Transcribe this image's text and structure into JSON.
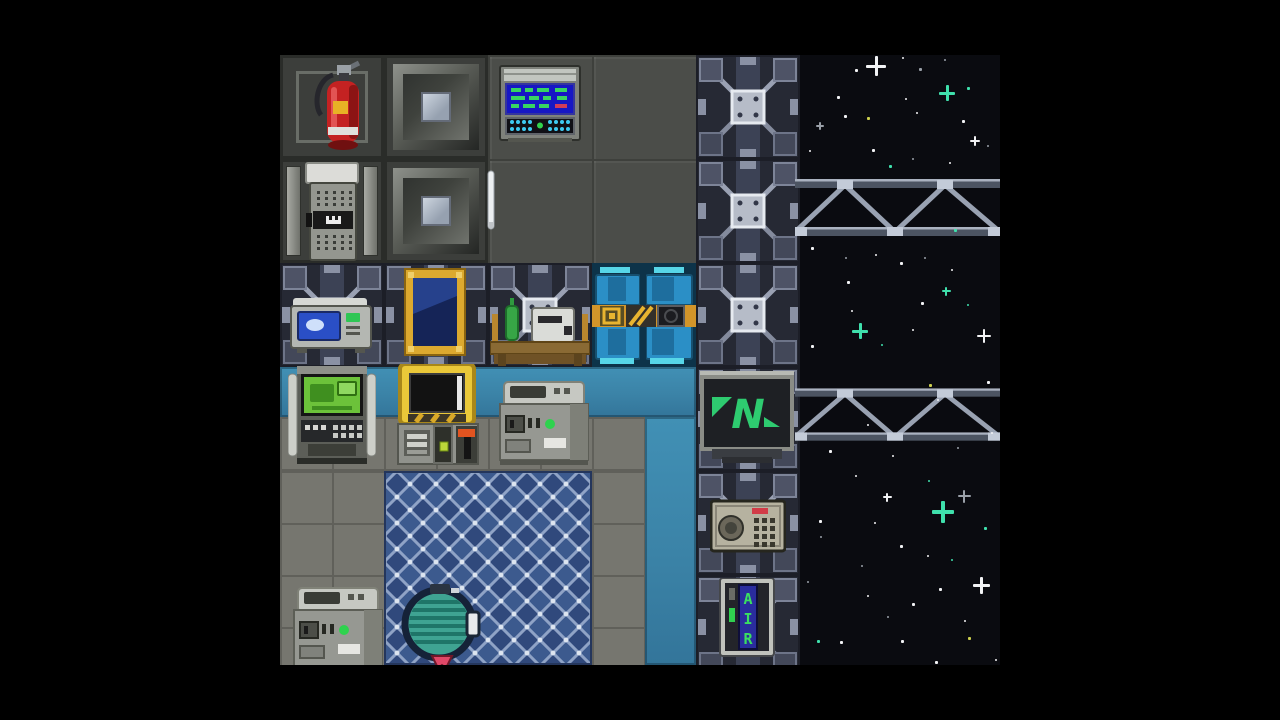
{
  "app": {
    "type": "pixel-game-screenshot",
    "description": "top-down space station game frame, letterboxed"
  },
  "viewport": {
    "x": 280,
    "y": 55,
    "w": 720,
    "h": 610
  },
  "letterbox": {
    "color": "#000000",
    "left_width": 280,
    "right_width": 280,
    "top_height": 55,
    "bottom_height": 55
  },
  "labels": {
    "air_alarm": "AIR",
    "brand_sign": "N"
  },
  "palette": {
    "space": "#0a0b10",
    "wall_dark": "#3c3e3b",
    "floor_dark": "#4b4d49",
    "floor_gray": "#76766f",
    "wall_teal": "#3b83a7",
    "carpet_blue": "#3c5a8e",
    "carpet_line": "#8fa3c6",
    "door_blue": "#2b8fc6",
    "door_stripe": "#d2952a",
    "brand_green": "#2ecb70",
    "extinguisher_red": "#c42222",
    "frame_gold": "#dca92f",
    "screen_green": "#6cc23a",
    "screen_blue": "#1717c4",
    "star_teal": "#3fe0ac",
    "star_yellow": "#cdd04e"
  },
  "regions": [
    {
      "kind": "space",
      "name": "space-background",
      "x": 800,
      "y": 55,
      "w": 200,
      "h": 610,
      "interactable": false
    },
    {
      "kind": "floor-dark",
      "name": "dark-floor",
      "x": 488,
      "y": 55,
      "w": 208,
      "h": 208,
      "interactable": false
    },
    {
      "kind": "wall-plain",
      "name": "wall-tile",
      "x": 280,
      "y": 55,
      "w": 104,
      "h": 104,
      "interactable": false
    },
    {
      "kind": "wall-panel",
      "name": "wall-tile-panel",
      "x": 384,
      "y": 55,
      "w": 104,
      "h": 104,
      "interactable": false
    },
    {
      "kind": "wall-doorframe",
      "name": "wall-door-frame",
      "x": 280,
      "y": 159,
      "w": 104,
      "h": 104,
      "interactable": false
    },
    {
      "kind": "wall-panel",
      "name": "wall-tile-panel",
      "x": 384,
      "y": 159,
      "w": 104,
      "h": 104,
      "interactable": false
    },
    {
      "kind": "xbrace",
      "name": "reinforced-wall-tile",
      "x": 696,
      "y": 55,
      "w": 104,
      "h": 104,
      "interactable": false
    },
    {
      "kind": "xbrace",
      "name": "reinforced-wall-tile",
      "x": 696,
      "y": 159,
      "w": 104,
      "h": 104,
      "interactable": false
    },
    {
      "kind": "xbrace",
      "name": "reinforced-wall-tile",
      "x": 280,
      "y": 263,
      "w": 104,
      "h": 104,
      "interactable": false
    },
    {
      "kind": "xbrace",
      "name": "reinforced-wall-tile",
      "x": 384,
      "y": 263,
      "w": 104,
      "h": 104,
      "interactable": false
    },
    {
      "kind": "xbrace",
      "name": "reinforced-wall-tile",
      "x": 488,
      "y": 263,
      "w": 104,
      "h": 104,
      "interactable": false
    },
    {
      "kind": "airlock",
      "name": "airlock-door",
      "x": 592,
      "y": 263,
      "w": 104,
      "h": 104,
      "interactable": true
    },
    {
      "kind": "xbrace",
      "name": "reinforced-wall-tile",
      "x": 696,
      "y": 263,
      "w": 104,
      "h": 104,
      "interactable": false
    },
    {
      "kind": "teal",
      "name": "teal-wall-band",
      "x": 280,
      "y": 367,
      "w": 416,
      "h": 50,
      "interactable": false
    },
    {
      "kind": "floor-mid",
      "name": "gray-floor",
      "x": 280,
      "y": 417,
      "w": 365,
      "h": 54,
      "interactable": false
    },
    {
      "kind": "floor-mid",
      "name": "gray-floor",
      "x": 280,
      "y": 471,
      "w": 104,
      "h": 194,
      "interactable": false
    },
    {
      "kind": "floor-mid",
      "name": "gray-floor",
      "x": 592,
      "y": 471,
      "w": 53,
      "h": 194,
      "interactable": false
    },
    {
      "kind": "teal",
      "name": "teal-wall-strip",
      "x": 645,
      "y": 417,
      "w": 51,
      "h": 248,
      "interactable": false
    },
    {
      "kind": "carpet",
      "name": "pool-floor-carpet",
      "x": 384,
      "y": 471,
      "w": 208,
      "h": 194,
      "interactable": false
    },
    {
      "kind": "xbrace",
      "name": "reinforced-wall-tile",
      "x": 696,
      "y": 367,
      "w": 104,
      "h": 104,
      "interactable": false
    },
    {
      "kind": "xbrace",
      "name": "reinforced-wall-tile",
      "x": 696,
      "y": 471,
      "w": 104,
      "h": 104,
      "interactable": false
    },
    {
      "kind": "xbrace",
      "name": "reinforced-wall-tile",
      "x": 696,
      "y": 575,
      "w": 104,
      "h": 104,
      "interactable": false
    }
  ],
  "trusses": [
    {
      "name": "space-truss",
      "x": 795,
      "y": 172,
      "w": 205,
      "h": 72
    },
    {
      "name": "space-truss",
      "x": 795,
      "y": 382,
      "w": 205,
      "h": 66
    }
  ],
  "sprites": [
    {
      "kind": "extinguisher",
      "name": "fire-extinguisher",
      "x": 297,
      "y": 57,
      "w": 80,
      "h": 100,
      "interactable": true
    },
    {
      "kind": "console",
      "name": "wall-console",
      "x": 499,
      "y": 60,
      "w": 82,
      "h": 86,
      "interactable": true
    },
    {
      "kind": "door",
      "name": "maintenance-door",
      "x": 299,
      "y": 161,
      "w": 66,
      "h": 101,
      "interactable": true
    },
    {
      "kind": "pen",
      "name": "pen-item",
      "x": 486,
      "y": 170,
      "w": 10,
      "h": 64,
      "interactable": true
    },
    {
      "kind": "microwave",
      "name": "microwave",
      "x": 289,
      "y": 294,
      "w": 84,
      "h": 62,
      "interactable": true
    },
    {
      "kind": "painting",
      "name": "painting",
      "x": 404,
      "y": 267,
      "w": 62,
      "h": 90,
      "interactable": true
    },
    {
      "kind": "tableset",
      "name": "table-with-items",
      "x": 490,
      "y": 288,
      "w": 100,
      "h": 78,
      "interactable": true
    },
    {
      "kind": "atm",
      "name": "atm-machine",
      "x": 288,
      "y": 366,
      "w": 88,
      "h": 100,
      "interactable": true
    },
    {
      "kind": "research",
      "name": "yellow-console-machine",
      "x": 396,
      "y": 364,
      "w": 84,
      "h": 102,
      "interactable": true
    },
    {
      "kind": "graybox",
      "name": "portable-generator",
      "x": 494,
      "y": 378,
      "w": 100,
      "h": 88,
      "interactable": true
    },
    {
      "kind": "nsign",
      "name": "brand-sign",
      "x": 700,
      "y": 371,
      "w": 94,
      "h": 92,
      "interactable": true,
      "label": "N"
    },
    {
      "kind": "intercom",
      "name": "intercom",
      "x": 710,
      "y": 497,
      "w": 76,
      "h": 58,
      "interactable": true
    },
    {
      "kind": "airalarm",
      "name": "air-alarm",
      "x": 717,
      "y": 578,
      "w": 60,
      "h": 82,
      "interactable": true,
      "label": "AIR"
    },
    {
      "kind": "graybox",
      "name": "photocopier",
      "x": 288,
      "y": 584,
      "w": 100,
      "h": 88,
      "interactable": true
    },
    {
      "kind": "drain",
      "name": "pool-drain",
      "x": 396,
      "y": 584,
      "w": 86,
      "h": 84,
      "interactable": true
    }
  ],
  "stars": {
    "colors": {
      "w": "#f2f3f5",
      "g": "#9aa0a8",
      "t": "#3fe0ac",
      "y": "#cdd04e"
    },
    "points": [
      [
        876,
        66,
        "w",
        "plus",
        20
      ],
      [
        947,
        93,
        "t",
        "plus",
        16
      ],
      [
        975,
        141,
        "w",
        "plus",
        10
      ],
      [
        860,
        331,
        "t",
        "plus",
        16
      ],
      [
        984,
        336,
        "w",
        "plus",
        14
      ],
      [
        946,
        291,
        "t",
        "plus",
        9
      ],
      [
        943,
        512,
        "t",
        "plus",
        22
      ],
      [
        964,
        496,
        "g",
        "plus",
        13
      ],
      [
        981,
        585,
        "w",
        "plus",
        17
      ],
      [
        887,
        497,
        "w",
        "plus",
        9
      ],
      [
        820,
        126,
        "g",
        "plus",
        8
      ],
      [
        856,
        70,
        "w",
        "dot",
        3
      ],
      [
        920,
        69,
        "g",
        "dot",
        3
      ],
      [
        968,
        88,
        "t",
        "dot",
        3
      ],
      [
        838,
        97,
        "w",
        "dot",
        3
      ],
      [
        906,
        99,
        "w",
        "dot",
        2
      ],
      [
        845,
        116,
        "w",
        "dot",
        3
      ],
      [
        868,
        118,
        "y",
        "dot",
        3
      ],
      [
        917,
        113,
        "w",
        "dot",
        2
      ],
      [
        963,
        121,
        "w",
        "dot",
        3
      ],
      [
        988,
        146,
        "g",
        "dot",
        2
      ],
      [
        810,
        151,
        "w",
        "dot",
        2
      ],
      [
        873,
        150,
        "w",
        "dot",
        3
      ],
      [
        890,
        166,
        "t",
        "dot",
        3
      ],
      [
        913,
        159,
        "g",
        "dot",
        2
      ],
      [
        950,
        163,
        "w",
        "dot",
        2
      ],
      [
        903,
        58,
        "w",
        "dot",
        2
      ],
      [
        945,
        60,
        "g",
        "dot",
        2
      ],
      [
        812,
        248,
        "w",
        "dot",
        3
      ],
      [
        846,
        258,
        "g",
        "dot",
        2
      ],
      [
        876,
        255,
        "w",
        "dot",
        2
      ],
      [
        901,
        263,
        "w",
        "dot",
        3
      ],
      [
        925,
        258,
        "g",
        "dot",
        2
      ],
      [
        952,
        270,
        "w",
        "dot",
        2
      ],
      [
        848,
        282,
        "w",
        "dot",
        3
      ],
      [
        922,
        303,
        "w",
        "dot",
        3
      ],
      [
        852,
        311,
        "w",
        "dot",
        2
      ],
      [
        812,
        346,
        "w",
        "dot",
        3
      ],
      [
        882,
        345,
        "t",
        "dot",
        2
      ],
      [
        913,
        330,
        "w",
        "dot",
        2
      ],
      [
        968,
        305,
        "t",
        "dot",
        2
      ],
      [
        955,
        230,
        "t",
        "dot",
        3
      ],
      [
        930,
        385,
        "y",
        "dot",
        3
      ],
      [
        938,
        400,
        "w",
        "dot",
        2
      ],
      [
        988,
        382,
        "w",
        "dot",
        3
      ],
      [
        830,
        451,
        "w",
        "dot",
        3
      ],
      [
        893,
        456,
        "w",
        "dot",
        2
      ],
      [
        856,
        476,
        "w",
        "dot",
        2
      ],
      [
        820,
        521,
        "w",
        "dot",
        3
      ],
      [
        929,
        481,
        "t",
        "dot",
        2
      ],
      [
        985,
        528,
        "t",
        "dot",
        3
      ],
      [
        901,
        546,
        "w",
        "dot",
        3
      ],
      [
        821,
        537,
        "g",
        "dot",
        2
      ],
      [
        928,
        556,
        "w",
        "dot",
        2
      ],
      [
        952,
        560,
        "t",
        "dot",
        2
      ],
      [
        862,
        566,
        "g",
        "dot",
        2
      ],
      [
        940,
        589,
        "w",
        "dot",
        3
      ],
      [
        868,
        596,
        "w",
        "dot",
        2
      ],
      [
        913,
        604,
        "w",
        "dot",
        3
      ],
      [
        965,
        621,
        "w",
        "dot",
        2
      ],
      [
        902,
        641,
        "w",
        "dot",
        3
      ],
      [
        818,
        641,
        "t",
        "dot",
        3
      ],
      [
        841,
        642,
        "w",
        "dot",
        3
      ],
      [
        936,
        662,
        "w",
        "dot",
        3
      ],
      [
        969,
        638,
        "y",
        "dot",
        3
      ],
      [
        875,
        523,
        "w",
        "dot",
        2
      ],
      [
        808,
        582,
        "g",
        "dot",
        2
      ],
      [
        888,
        617,
        "g",
        "dot",
        2
      ],
      [
        996,
        660,
        "w",
        "dot",
        2
      ],
      [
        992,
        433,
        "w",
        "dot",
        2
      ],
      [
        958,
        448,
        "g",
        "dot",
        2
      ],
      [
        868,
        425,
        "w",
        "dot",
        2
      ]
    ]
  }
}
